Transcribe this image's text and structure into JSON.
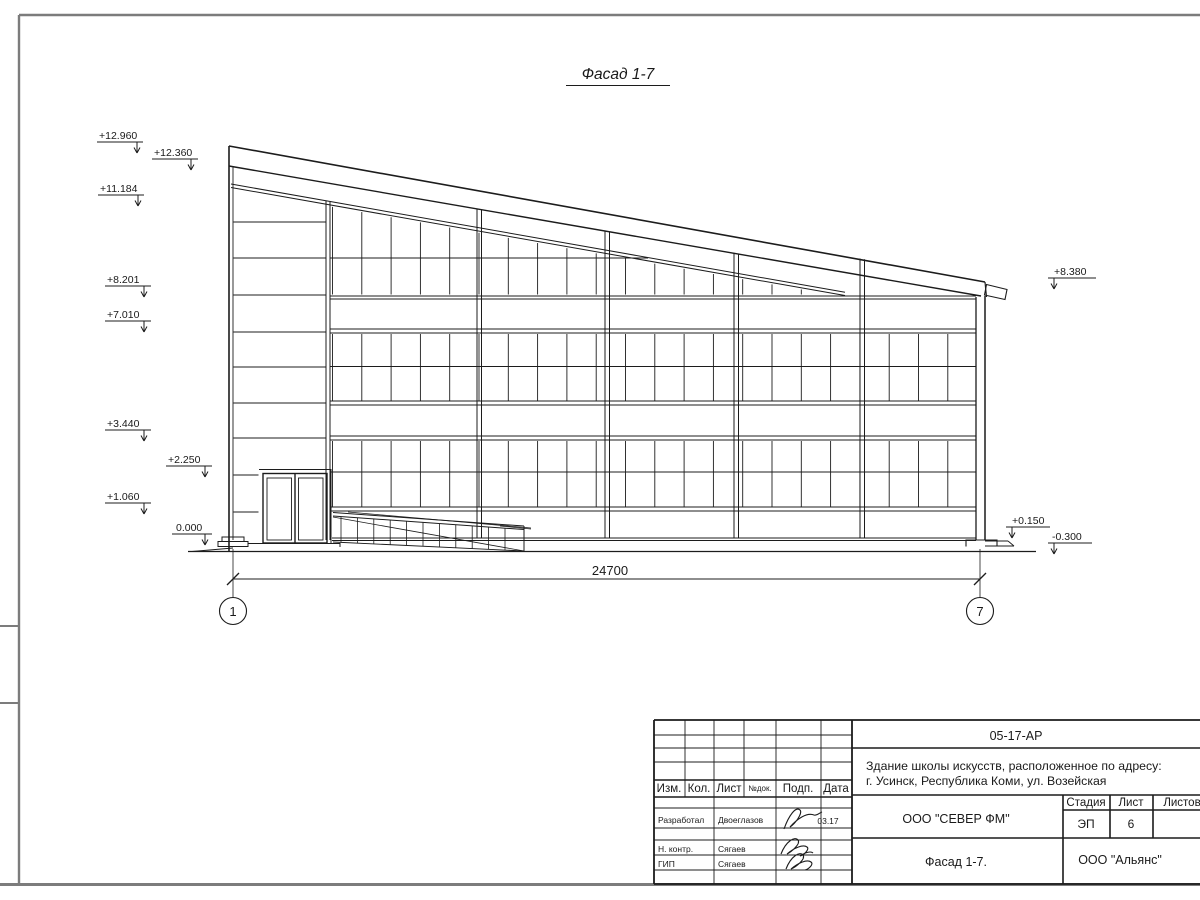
{
  "sheet": {
    "view_title": "Фасад 1-7",
    "dimension_total": "24700",
    "axes": {
      "left": "1",
      "right": "7"
    },
    "elevations_left": [
      "+12.960",
      "+12.360",
      "+11.184",
      "+8.201",
      "+7.010",
      "+3.440",
      "+2.250",
      "+1.060",
      "0.000"
    ],
    "elevations_right": [
      "+8.380",
      "+0.150",
      "-0.300"
    ]
  },
  "titleblock": {
    "doc_number": "05-17-АР",
    "project_line1": "Здание школы искусств, расположенное по адресу:",
    "project_line2": "г. Усинск, Республика Коми, ул. Возейская",
    "header_cols": {
      "izm": "Изм.",
      "kol": "Кол.",
      "list": "Лист",
      "ndok": "№док.",
      "podp": "Подп.",
      "data": "Дата"
    },
    "stage": {
      "label": "Стадия",
      "value": "ЭП"
    },
    "sheet_no": {
      "label": "Лист",
      "value": "6"
    },
    "sheets_total": {
      "label": "Листов",
      "value": ""
    },
    "org": "ООО \"СЕВЕР ФМ\"",
    "view_name": "Фасад 1-7.",
    "contractor": "ООО \"Альянс\"",
    "roles": [
      {
        "role": "Разработал",
        "name": "Двоеглазов",
        "date": "03.17"
      },
      {
        "role": "Н. контр.",
        "name": "Сягаев",
        "date": ""
      },
      {
        "role": "ГИП",
        "name": "Сягаев",
        "date": ""
      }
    ]
  }
}
